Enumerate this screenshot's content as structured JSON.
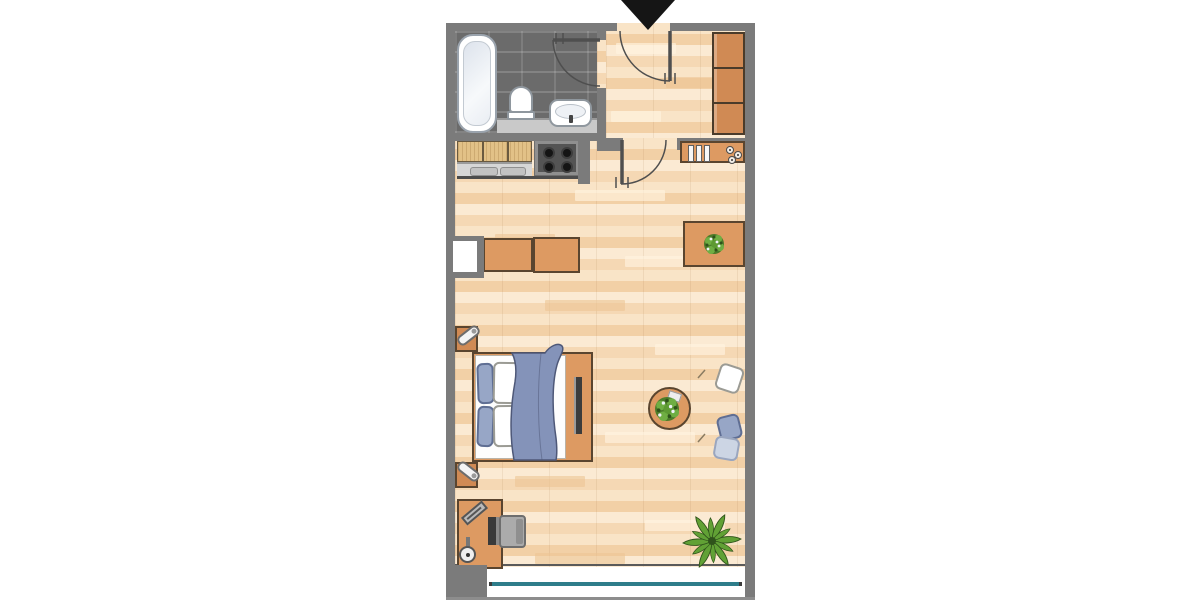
{
  "scene": {
    "type": "apartment-floor-plan",
    "description": "Top-down floor plan of a studio apartment with bathroom, entrance hall, kitchenette and a combined living and sleeping room with balcony window",
    "entrance_marker": "black-arrow-pointing-down"
  },
  "palette": {
    "wall": "#7b7b7b",
    "wallLight": "#8d8d8d",
    "floor": "#f6ddbd",
    "tile": "#6b6b6b",
    "orange": "#dd9a62",
    "orangeDark": "#d08a54",
    "orangeOutline": "#5a452f",
    "wood": "#e2c187",
    "counter": "#d6d6d6",
    "counterTray": "#c2c2c2",
    "stove": "#545454",
    "tan": "#d8c2a2",
    "tanDark": "#cdb593",
    "tanOutline": "#44403a",
    "cushionBlue": "#97a6c6",
    "cushionBlueDark": "#5f6e93",
    "pillowLight": "#ccd5e4",
    "blanket": "#8493b9",
    "blanketOutline": "#4e5878",
    "green": "#61a135",
    "greenDark": "#2f531b",
    "teal": "#2e7d8a",
    "arrow": "#151515",
    "chairGray": "#ababab",
    "monitor": "#3a3a3a",
    "white": "#ffffff"
  },
  "rooms": [
    {
      "name": "bathroom",
      "floor": "dark-gray-tiles",
      "fixtures": [
        "bathtub",
        "toilet",
        "washbasin",
        "vanity-counter"
      ]
    },
    {
      "name": "entrance-hall",
      "floor": "light-wood",
      "furniture": [
        "built-in-wardrobe-3-sections"
      ]
    },
    {
      "name": "kitchenette",
      "floor": "light-wood",
      "fixtures": [
        "cabinet-3-doors",
        "sink-counter-2-trays",
        "stove-4-burners",
        "wall-shelf-3-books",
        "3-wall-hooks"
      ]
    },
    {
      "name": "living-sleeping-room",
      "floor": "light-wood",
      "furniture": [
        "dining-table",
        "4-dining-chairs",
        "table-centerpiece-plant",
        "sideboard-2-sections",
        "wall-niche",
        "double-bed",
        "4-pillows",
        "blue-blanket",
        "2-nightstands",
        "2-table-lamps",
        "foot-wardrobe-with-dark-panel",
        "2-armchairs",
        "round-coffee-table-with-plant-and-book",
        "sofa",
        "3-sofa-cushions",
        "desk",
        "keyboard",
        "desk-lamp",
        "computer-monitor",
        "desk-chair",
        "palm-plant"
      ]
    }
  ],
  "doors": [
    {
      "name": "entrance-door",
      "swing": "into-hall"
    },
    {
      "name": "bathroom-door",
      "swing": "into-bathroom"
    },
    {
      "name": "living-room-door",
      "swing": "into-living-room"
    }
  ],
  "window": {
    "location": "bottom-wall",
    "glazing_color": "teal"
  },
  "counts": {
    "dining_chairs": 4,
    "armchairs": 2,
    "plants": 3,
    "pillows_on_bed": 4,
    "sofa_cushions": 3
  }
}
